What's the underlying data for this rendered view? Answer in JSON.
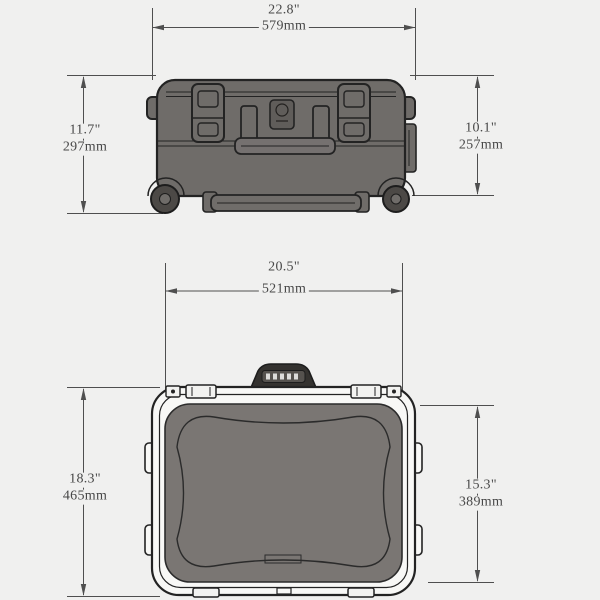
{
  "page": {
    "background_color": "#f0f0ef",
    "description": "Case dimension diagram, front view and top view"
  },
  "drawing": {
    "dimension_line_color": "#4f4f4f",
    "outline_color": "#232323",
    "case_fill": "#6f6c69",
    "lid_fill": "#7a7673",
    "shell_fill": "#f8f8f6",
    "wheel_fill": "#4c4946",
    "handle_fill": "#34322f",
    "text_color": "#474747"
  },
  "front_view": {
    "width": {
      "inches": "22.8\"",
      "mm": "579mm"
    },
    "height_overall": {
      "inches": "11.7\"",
      "mm": "297mm"
    },
    "height_body": {
      "inches": "10.1\"",
      "mm": "257mm"
    }
  },
  "top_view": {
    "width": {
      "inches": "20.5\"",
      "mm": "521mm"
    },
    "depth_overall": {
      "inches": "18.3\"",
      "mm": "465mm"
    },
    "depth_body": {
      "inches": "15.3\"",
      "mm": "389mm"
    }
  }
}
